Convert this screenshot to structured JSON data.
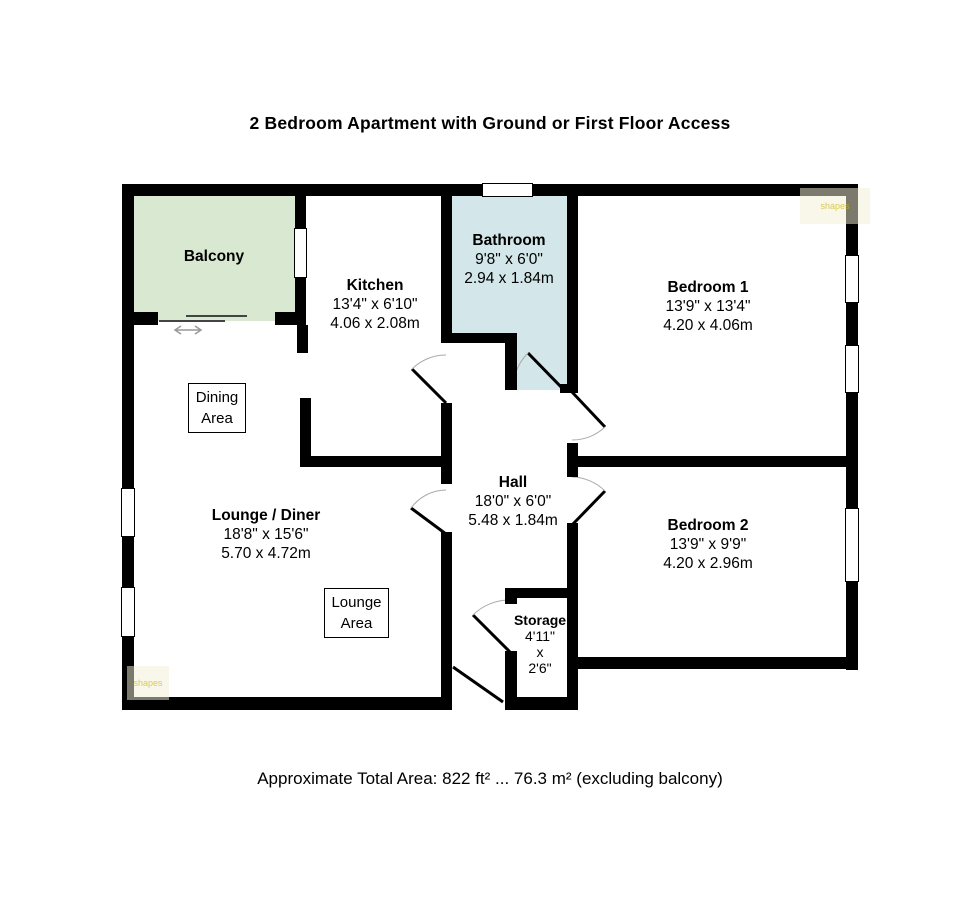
{
  "title": "2 Bedroom Apartment with Ground or First Floor Access",
  "footer": "Approximate Total Area: 822 ft² ... 76.3 m² (excluding balcony)",
  "watermark": "shapes",
  "colors": {
    "wall": "#000000",
    "balcony_fill": "#d9e8d1",
    "bathroom_fill": "#d3e6e9"
  },
  "rooms": {
    "balcony": {
      "name": "Balcony"
    },
    "kitchen": {
      "name": "Kitchen",
      "imperial": "13'4\" x 6'10\"",
      "metric": "4.06 x 2.08m"
    },
    "bathroom": {
      "name": "Bathroom",
      "imperial": "9'8\" x 6'0\"",
      "metric": "2.94 x 1.84m"
    },
    "bedroom1": {
      "name": "Bedroom 1",
      "imperial": "13'9\" x 13'4\"",
      "metric": "4.20 x 4.06m"
    },
    "bedroom2": {
      "name": "Bedroom 2",
      "imperial": "13'9\" x 9'9\"",
      "metric": "4.20 x 2.96m"
    },
    "hall": {
      "name": "Hall",
      "imperial": "18'0\" x 6'0\"",
      "metric": "5.48 x 1.84m"
    },
    "storage": {
      "name": "Storage",
      "line1": "4'11\"",
      "line2": "x",
      "line3": "2'6\""
    },
    "dining_area": {
      "line1": "Dining",
      "line2": "Area"
    },
    "lounge_area": {
      "line1": "Lounge",
      "line2": "Area"
    }
  }
}
